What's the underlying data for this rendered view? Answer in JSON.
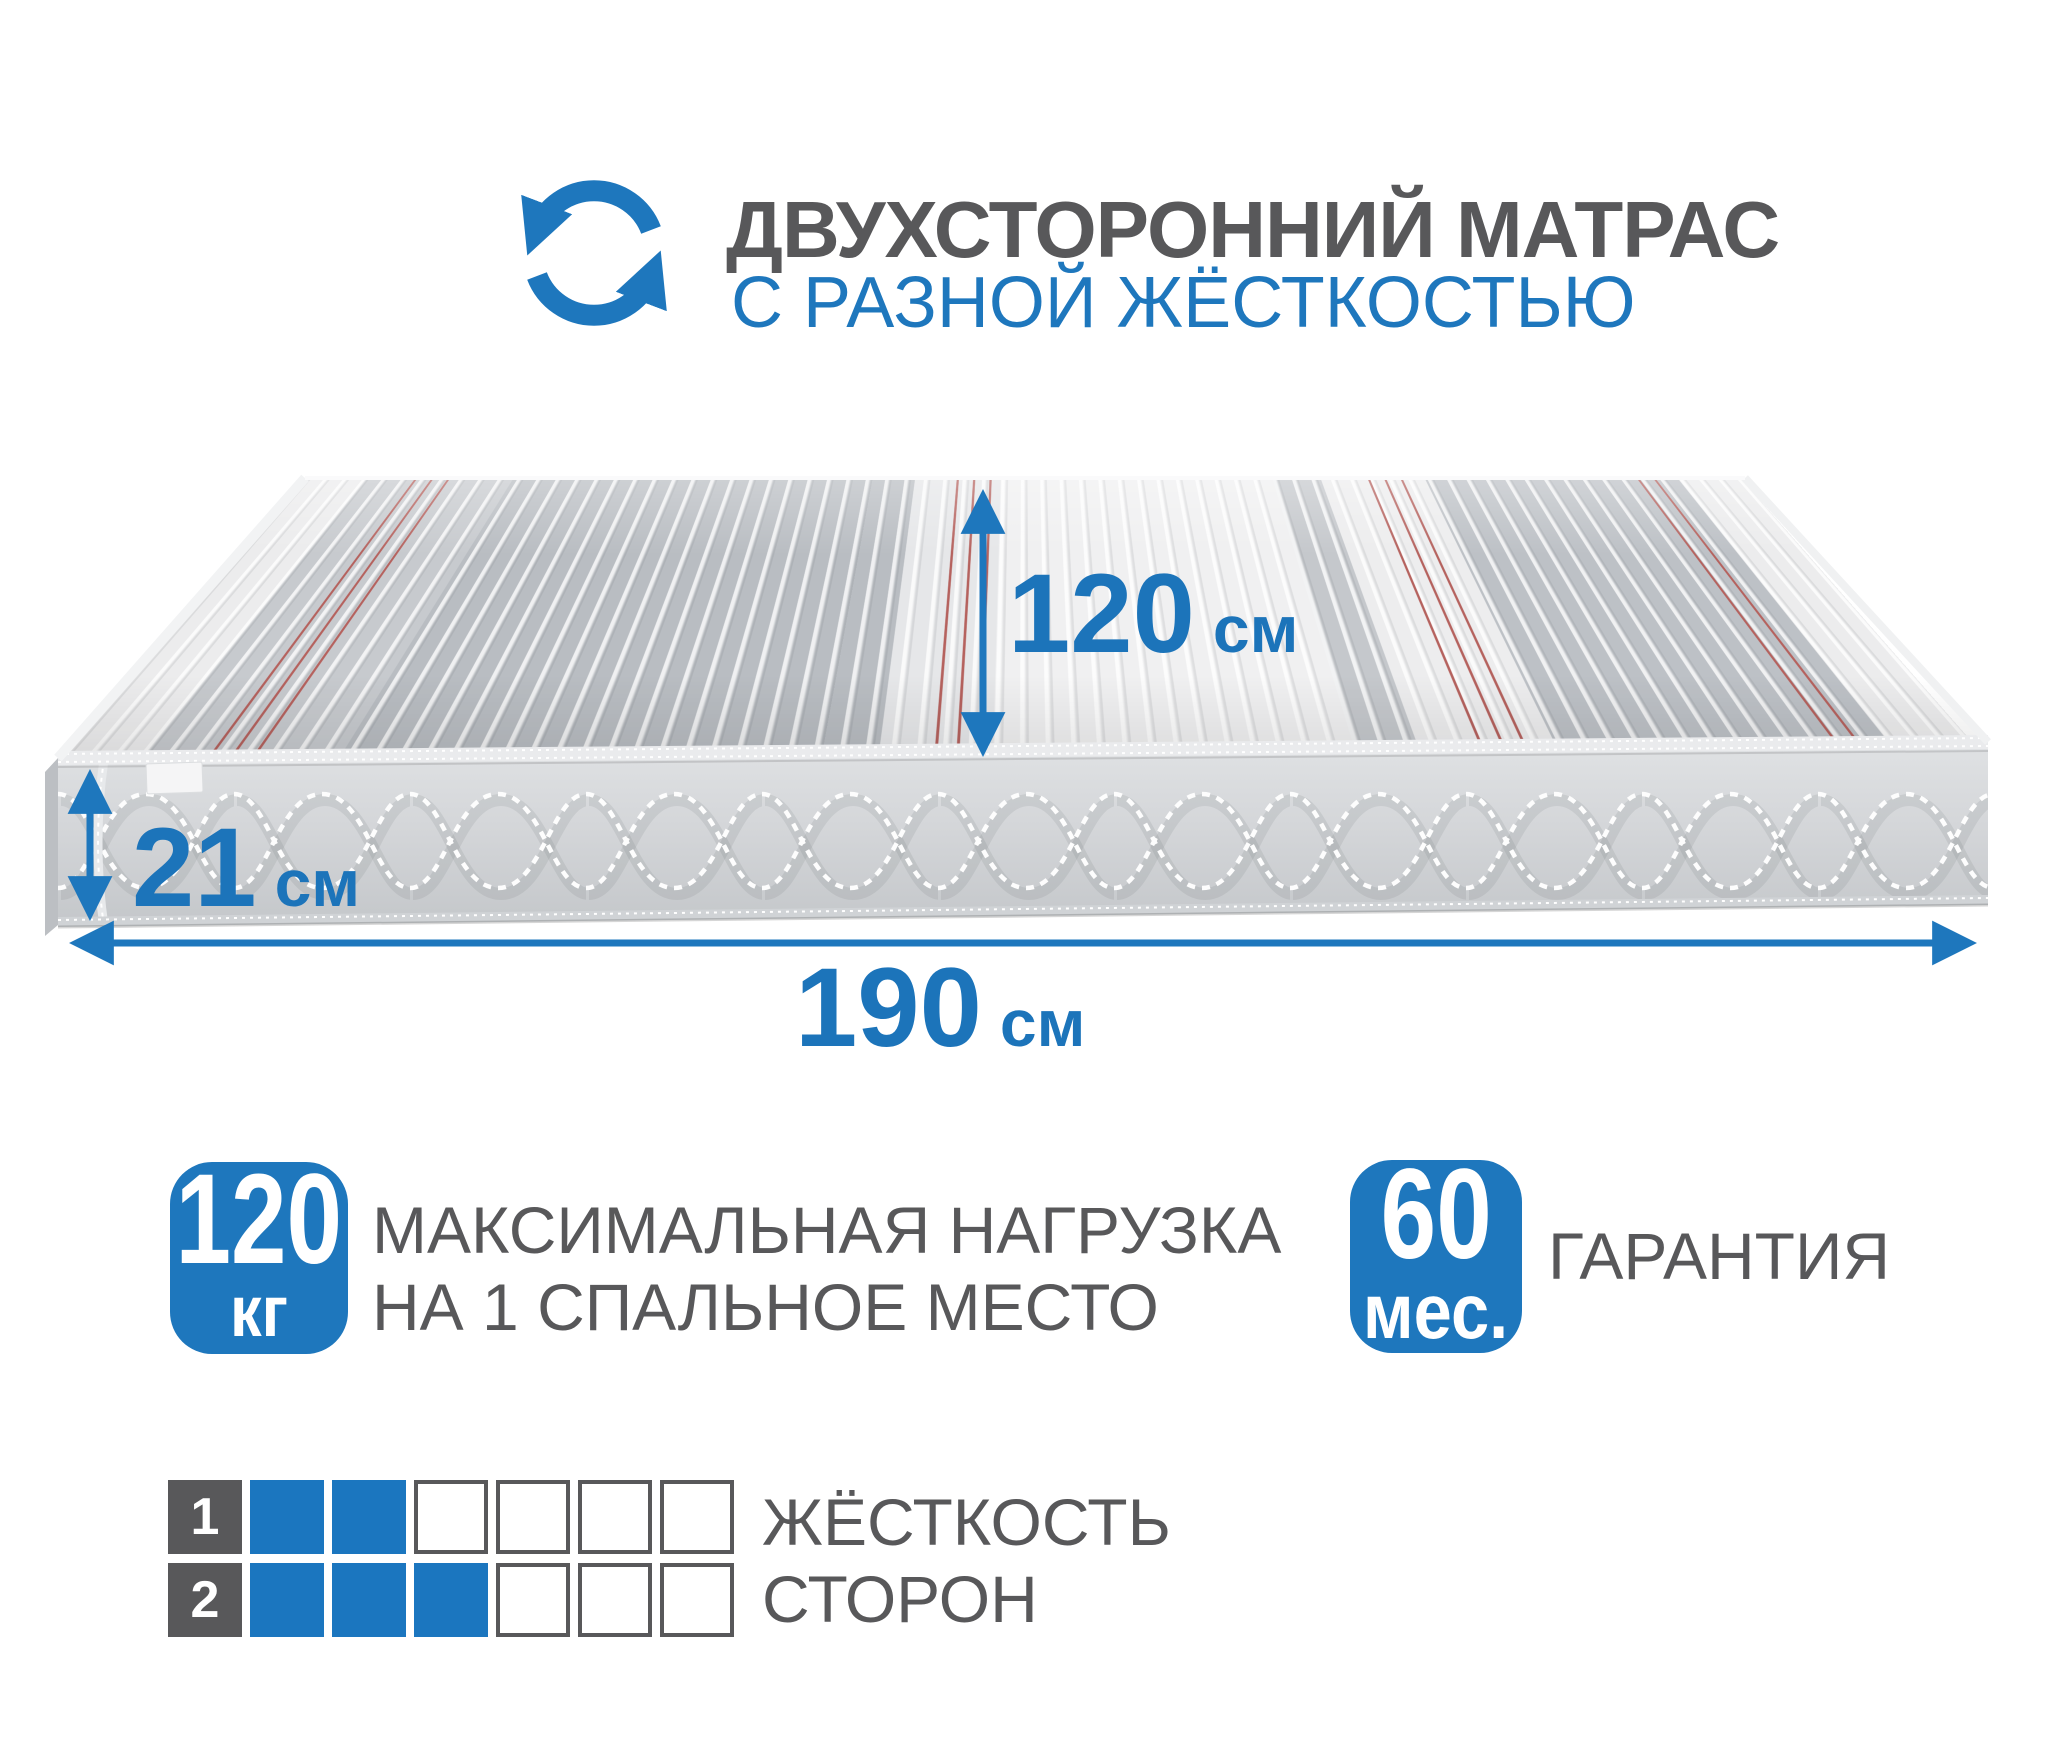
{
  "colors": {
    "accent_blue": "#1e77bd",
    "text_gray": "#58585a",
    "firmness_filled": "#1b76bf",
    "firmness_border": "#58585a",
    "red_stitch": "#b5625e",
    "side_fabric": "#d3d5d8"
  },
  "header": {
    "icon": "rotate-arrows-icon",
    "title": "ДВУХСТОРОННИЙ МАТРАС",
    "subtitle": "С РАЗНОЙ ЖЁСТКОСТЬЮ"
  },
  "dimensions": {
    "depth": {
      "value": "120",
      "unit": "см"
    },
    "height": {
      "value": "21",
      "unit": "см"
    },
    "length": {
      "value": "190",
      "unit": "см"
    }
  },
  "features": {
    "max_load": {
      "badge_value": "120",
      "badge_unit": "кг",
      "text_line1": "МАКСИМАЛЬНАЯ НАГРУЗКА",
      "text_line2": "НА 1 СПАЛЬНОЕ МЕСТО"
    },
    "warranty": {
      "badge_value": "60",
      "badge_unit": "мес.",
      "label": "ГАРАНТИЯ"
    }
  },
  "firmness": {
    "title_line1": "ЖЁСТКОСТЬ",
    "title_line2": "СТОРОН",
    "rows": [
      {
        "label": "1",
        "filled": 2,
        "total": 6
      },
      {
        "label": "2",
        "filled": 3,
        "total": 6
      }
    ]
  }
}
